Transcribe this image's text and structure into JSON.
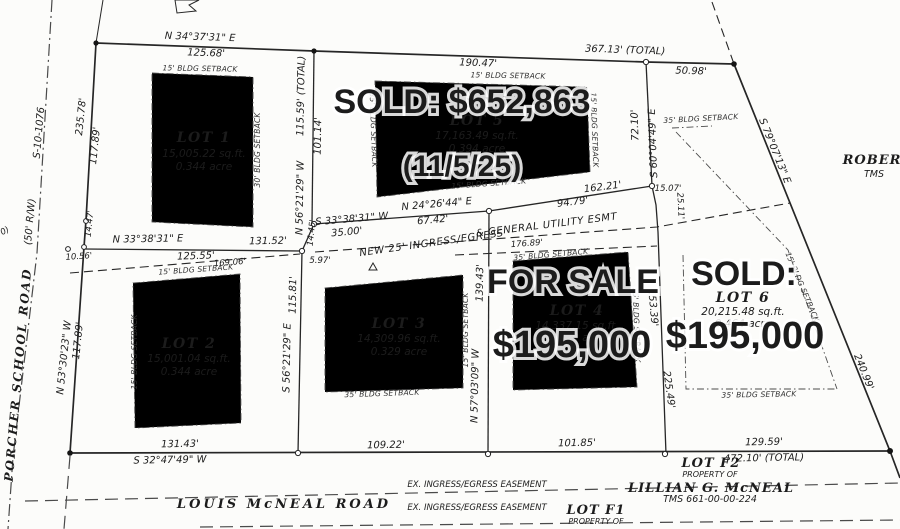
{
  "map": {
    "adjacent_right": {
      "name": "ROBER",
      "tms": "TMS"
    },
    "roads": {
      "porcher": {
        "name": "PORCHER  SCHOOL  ROAD",
        "rw": "(50' R/W)",
        "route": "S-10-1076"
      },
      "louis": {
        "name": "LOUIS  McNEAL  ROAD"
      }
    },
    "easements": {
      "new25_a": "NEW 25' INGRESS/EGRESS",
      "new25_b": "& GENERAL UTILITY ESMT",
      "ex": "EX. INGRESS/EGRESS EASEMENT"
    },
    "south_parcels": {
      "prop_of": "PROPERTY OF",
      "f2": {
        "lot": "LOT F2",
        "owner": "LILLIAN G. McNEAL",
        "tms": "TMS 661-00-00-224"
      },
      "f1": {
        "lot": "LOT F1"
      }
    },
    "lots": {
      "lot1": {
        "title": "LOT 1",
        "sqft": "15,005.22 sq.ft.",
        "acre": "0.344 acre"
      },
      "lot2": {
        "title": "LOT 2",
        "sqft": "15,001.04 sq.ft.",
        "acre": "0.344 acre"
      },
      "lot3": {
        "title": "LOT 3",
        "sqft": "14,309.96 sq.ft.",
        "acre": "0.329 acre"
      },
      "lot4": {
        "title": "LOT 4",
        "sqft": "14,337.15 sq.ft.",
        "acre": "0.329 acre"
      },
      "lot5": {
        "title": "LOT 5",
        "sqft": "17,163.49 sq.ft.",
        "acre": "0.394 acre"
      },
      "lot6": {
        "title": "LOT 6",
        "sqft": "20,215.48 sq.ft.",
        "acre": "0.464 acre"
      }
    },
    "overlays": {
      "lot5_sold": "SOLD:  $652,863",
      "lot5_date": "(11/5/25)",
      "lot4_status": "FOR SALE",
      "lot4_price": "$195,000",
      "lot6_status": "SOLD:",
      "lot6_price": "$195,000",
      "sold_color": "#3b50a6",
      "sale_color": "#3cc06e"
    },
    "setbacks": {
      "sb15": "15' BLDG SETBACK",
      "sb30": "30' BLDG SETBACK",
      "sb35": "35' BLDG SETBACK"
    },
    "dims": {
      "n343731e": "N 34°37'31\" E",
      "len12568": "125.68'",
      "len19047": "190.47'",
      "len36713": "367.13' (TOTAL)",
      "len5098": "50.98'",
      "s790713e": "S 79°07'13\" E",
      "len24099": "240.99'",
      "len23578": "235.78'",
      "len11789_upper": "117.89'",
      "len1447": "14.47'",
      "len1056": "10.56'",
      "len11789_lower": "117.89'",
      "n533023w": "N 53°30'23\" W",
      "len11559": "115.59' (TOTAL)",
      "len10114": "101.14'",
      "n562129w": "N 56°21'29\" W",
      "len1445": "14.45'",
      "s333831w": "S 33°38'31\" W",
      "len3500": "35.00'",
      "n333831e": "N 33°38'31\" E",
      "len13152": "131.52'",
      "len12555": "125.55'",
      "len16906": "169.06'",
      "len597": "5.97'",
      "len11581": "115.81'",
      "s562129e": "S 56°21'29\" E",
      "n242644e": "N 24°26'44\" E",
      "len6742": "67.42'",
      "len9479": "94.79'",
      "len16221": "162.21'",
      "len17689": "176.89'",
      "len7210": "72.10'",
      "s600449e": "S 60°04'49\" E",
      "len1507": "15.07'",
      "len2511": "25.11'",
      "len15339": "153.39'",
      "len22549": "225.49'",
      "len13943": "139.43'",
      "n570309w": "N 57°03'09\" W",
      "len13143": "131.43'",
      "s324749w": "S 32°47'49\" W",
      "len10922": "109.22'",
      "len10185": "101.85'",
      "len12959": "129.59'",
      "len47210": "472.10' (TOTAL)",
      "edge_fragment": "0)"
    }
  }
}
